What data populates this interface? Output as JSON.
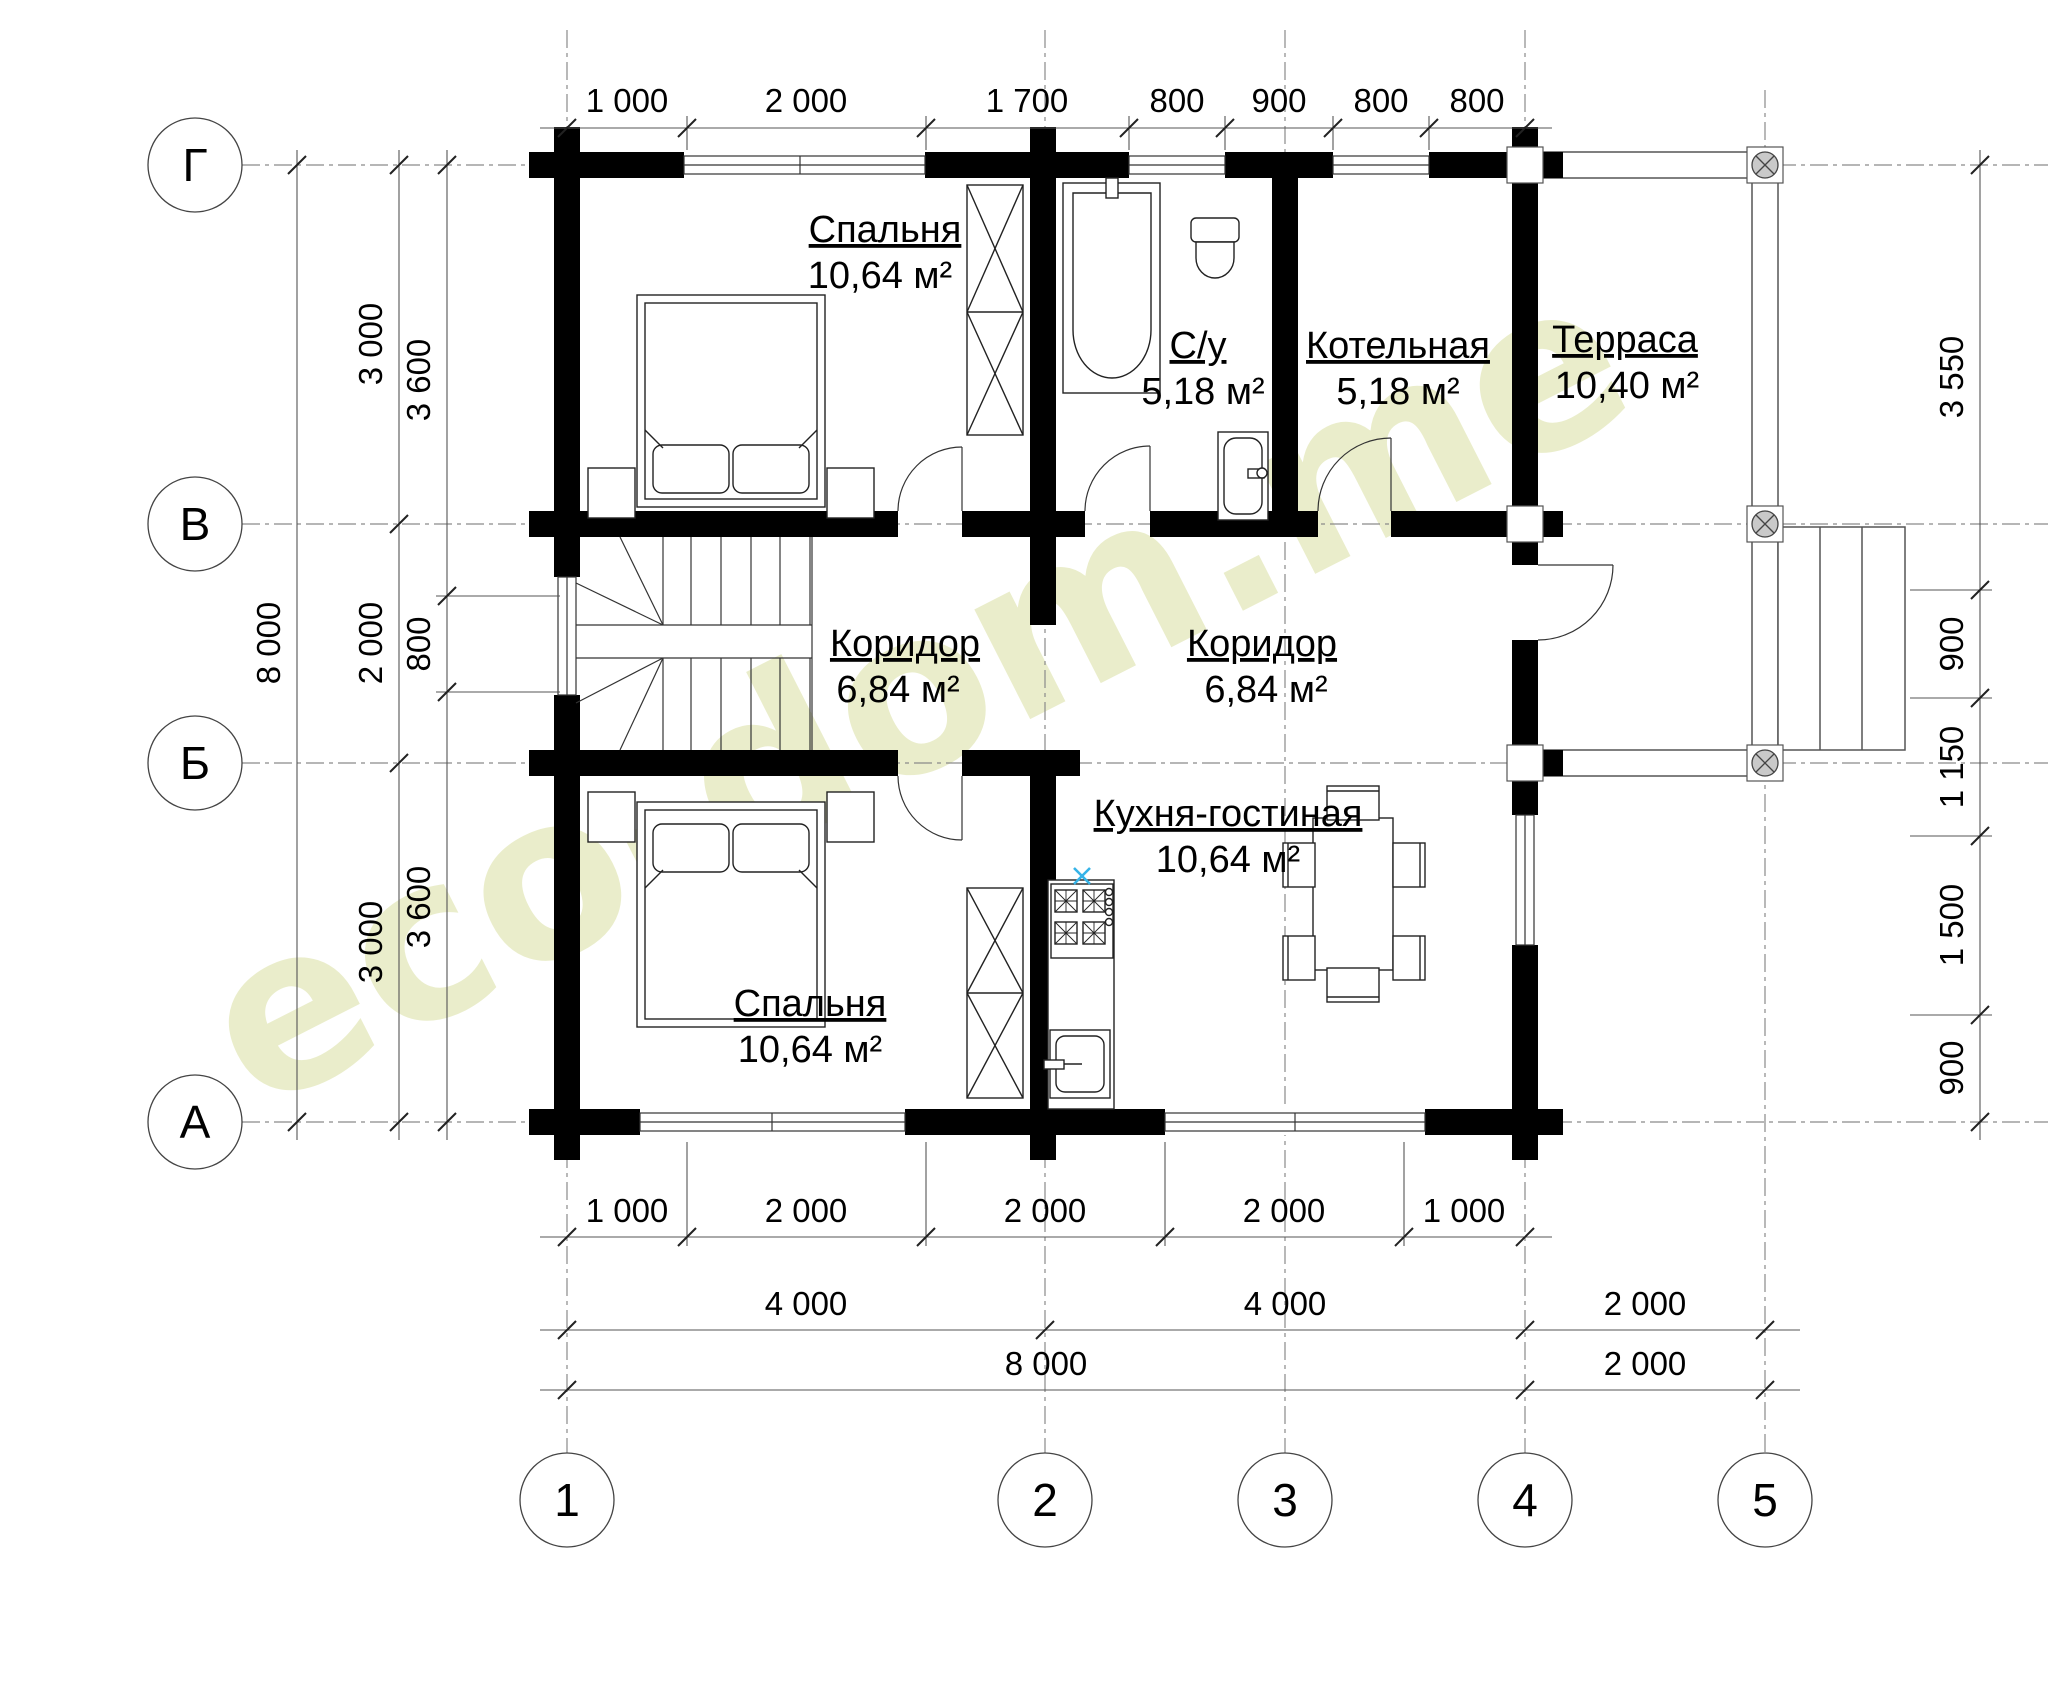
{
  "watermark": "eco-dom.me",
  "axes": {
    "rows": [
      {
        "label": "Г"
      },
      {
        "label": "В"
      },
      {
        "label": "Б"
      },
      {
        "label": "А"
      }
    ],
    "cols": [
      {
        "label": "1"
      },
      {
        "label": "2"
      },
      {
        "label": "3"
      },
      {
        "label": "4"
      },
      {
        "label": "5"
      }
    ]
  },
  "rooms": [
    {
      "name": "Спальня",
      "area": "10,64 м²"
    },
    {
      "name": "С/у",
      "area": "5,18 м²"
    },
    {
      "name": "Котельная",
      "area": "5,18 м²"
    },
    {
      "name": "Терраса",
      "area": "10,40 м²"
    },
    {
      "name": "Коридор",
      "area": "6,84 м²"
    },
    {
      "name": "Коридор",
      "area": "6,84 м²"
    },
    {
      "name": "Кухня-гостиная",
      "area": "10,64 м²"
    },
    {
      "name": "Спальня",
      "area": "10,64 м²"
    }
  ],
  "dims": {
    "top": [
      "1 000",
      "2 000",
      "1 700",
      "800",
      "900",
      "800",
      "800"
    ],
    "left_outer": [
      "8 000"
    ],
    "left_axis": [
      "3 000",
      "2 000",
      "3 000"
    ],
    "left_inner": [
      "3 600",
      "800",
      "3 600"
    ],
    "right": [
      "3 550",
      "900",
      "1 150",
      "1 500",
      "900"
    ],
    "bottom_row1": [
      "1 000",
      "2 000",
      "2 000",
      "2 000",
      "1 000"
    ],
    "bottom_row2": [
      "4 000",
      "4 000",
      "2 000"
    ],
    "bottom_row3": [
      "8 000",
      "2 000"
    ]
  }
}
